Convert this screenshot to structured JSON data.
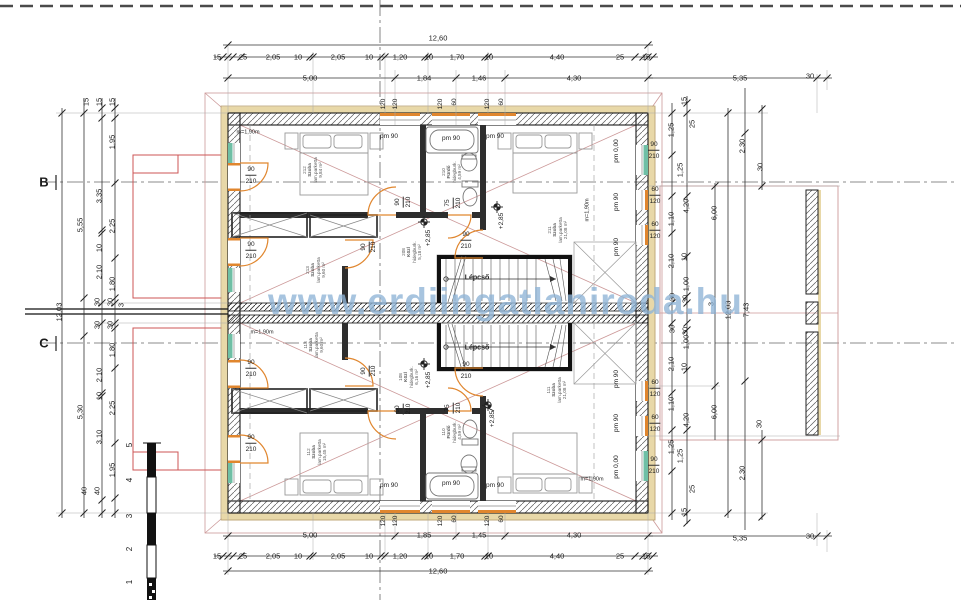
{
  "watermark": "www.erdiingatlaniroda.hu",
  "colors": {
    "door_window_accent": "#e0862e",
    "teal_window": "#6fbfa5",
    "red_outline": "#cc5555",
    "pink_roof": "#cc9999",
    "insulation_tan": "#e8d8a8",
    "watermark_blue": "#8eb4d6",
    "wall_dark": "#2e2e2e"
  },
  "rooms": [
    {
      "id": "212",
      "name": "Szoba",
      "floor": "lam.parketta",
      "area": "9,84 m²",
      "x": 313,
      "y": 170
    },
    {
      "id": "213",
      "name": "Szoba",
      "floor": "lam.parketta",
      "area": "9,60 m²",
      "x": 316,
      "y": 270
    },
    {
      "id": "208",
      "name": "Közl",
      "floor": "hidegburk.",
      "area": "5,18 m²",
      "x": 412,
      "y": 252
    },
    {
      "id": "210",
      "name": "Fürdő",
      "floor": "hidegburk.",
      "area": "4,59 m²",
      "x": 452,
      "y": 172
    },
    {
      "id": "211",
      "name": "Szoba",
      "floor": "lam.parketta",
      "area": "21,08 m²",
      "x": 558,
      "y": 230
    },
    {
      "id": "113",
      "name": "Szoba",
      "floor": "lam.parketta",
      "area": "9,60 m²",
      "x": 314,
      "y": 345
    },
    {
      "id": "112",
      "name": "Szoba",
      "floor": "lam.parketta",
      "area": "15,45 m²",
      "x": 317,
      "y": 452
    },
    {
      "id": "108",
      "name": "Közl",
      "floor": "hidegburk.",
      "area": "6,16 m²",
      "x": 409,
      "y": 377
    },
    {
      "id": "110",
      "name": "Fürdő",
      "floor": "hidegburk.",
      "area": "4,59 m²",
      "x": 452,
      "y": 432
    },
    {
      "id": "111",
      "name": "Szoba",
      "floor": "lam.parketta",
      "area": "21,08 m²",
      "x": 557,
      "y": 390
    }
  ],
  "labels": [
    {
      "t": "12,60",
      "x": 438,
      "y": 38,
      "n": "dim-overall-top"
    },
    {
      "t": "15",
      "x": 217,
      "y": 57
    },
    {
      "t": "25",
      "x": 243,
      "y": 57
    },
    {
      "t": "2,05",
      "x": 273,
      "y": 57
    },
    {
      "t": "10",
      "x": 298,
      "y": 57
    },
    {
      "t": "2,05",
      "x": 338,
      "y": 57
    },
    {
      "t": "10",
      "x": 369,
      "y": 57
    },
    {
      "t": "1,20",
      "x": 400,
      "y": 57
    },
    {
      "t": "10",
      "x": 429,
      "y": 57
    },
    {
      "t": "1,70",
      "x": 457,
      "y": 57
    },
    {
      "t": "10",
      "x": 489,
      "y": 57
    },
    {
      "t": "4,40",
      "x": 557,
      "y": 57
    },
    {
      "t": "25",
      "x": 620,
      "y": 57
    },
    {
      "t": "15",
      "x": 646,
      "y": 57
    },
    {
      "t": "5,00",
      "x": 310,
      "y": 78
    },
    {
      "t": "1,84",
      "x": 424,
      "y": 78
    },
    {
      "t": "1,46",
      "x": 479,
      "y": 78
    },
    {
      "t": "4,30",
      "x": 574,
      "y": 78
    },
    {
      "t": "5,35",
      "x": 740,
      "y": 78
    },
    {
      "t": "30",
      "x": 810,
      "y": 76
    },
    {
      "t": "120",
      "x": 384,
      "y": 104,
      "r": 1,
      "s": 6.5
    },
    {
      "t": "120",
      "x": 396,
      "y": 104,
      "r": 1,
      "s": 6.5
    },
    {
      "t": "120",
      "x": 441,
      "y": 104,
      "r": 1,
      "s": 6.5
    },
    {
      "t": "60",
      "x": 455,
      "y": 102,
      "r": 1,
      "s": 6.5
    },
    {
      "t": "120",
      "x": 488,
      "y": 104,
      "r": 1,
      "s": 6.5
    },
    {
      "t": "60",
      "x": 502,
      "y": 102,
      "r": 1,
      "s": 6.5
    },
    {
      "t": "120",
      "x": 384,
      "y": 521,
      "r": 1,
      "s": 6.5
    },
    {
      "t": "120",
      "x": 396,
      "y": 521,
      "r": 1,
      "s": 6.5
    },
    {
      "t": "120",
      "x": 441,
      "y": 521,
      "r": 1,
      "s": 6.5
    },
    {
      "t": "60",
      "x": 455,
      "y": 519,
      "r": 1,
      "s": 6.5
    },
    {
      "t": "120",
      "x": 488,
      "y": 521,
      "r": 1,
      "s": 6.5
    },
    {
      "t": "60",
      "x": 502,
      "y": 519,
      "r": 1,
      "s": 6.5
    },
    {
      "t": "5,00",
      "x": 310,
      "y": 535
    },
    {
      "t": "1,85",
      "x": 424,
      "y": 535
    },
    {
      "t": "1,45",
      "x": 479,
      "y": 535
    },
    {
      "t": "4,30",
      "x": 574,
      "y": 535
    },
    {
      "t": "5,35",
      "x": 740,
      "y": 538
    },
    {
      "t": "30",
      "x": 810,
      "y": 536
    },
    {
      "t": "15",
      "x": 217,
      "y": 556
    },
    {
      "t": "25",
      "x": 243,
      "y": 556
    },
    {
      "t": "2,05",
      "x": 273,
      "y": 556
    },
    {
      "t": "10",
      "x": 298,
      "y": 556
    },
    {
      "t": "2,05",
      "x": 338,
      "y": 556
    },
    {
      "t": "10",
      "x": 369,
      "y": 556
    },
    {
      "t": "1,20",
      "x": 400,
      "y": 556
    },
    {
      "t": "10",
      "x": 429,
      "y": 556
    },
    {
      "t": "1,70",
      "x": 457,
      "y": 556
    },
    {
      "t": "10",
      "x": 489,
      "y": 556
    },
    {
      "t": "4,40",
      "x": 557,
      "y": 556
    },
    {
      "t": "25",
      "x": 620,
      "y": 556
    },
    {
      "t": "15",
      "x": 646,
      "y": 556
    },
    {
      "t": "12,60",
      "x": 438,
      "y": 571,
      "n": "dim-overall-bottom"
    },
    {
      "t": "12,03",
      "x": 59,
      "y": 312,
      "r": 1
    },
    {
      "t": "5,55",
      "x": 80,
      "y": 225,
      "r": 1
    },
    {
      "t": "5,30",
      "x": 80,
      "y": 412,
      "r": 1
    },
    {
      "t": "15",
      "x": 86,
      "y": 102,
      "r": 1
    },
    {
      "t": "15",
      "x": 99,
      "y": 102,
      "r": 1
    },
    {
      "t": "15",
      "x": 112,
      "y": 102,
      "r": 1
    },
    {
      "t": "1,95",
      "x": 112,
      "y": 142,
      "r": 1
    },
    {
      "t": "3,35",
      "x": 99,
      "y": 196,
      "r": 1
    },
    {
      "t": "2,25",
      "x": 112,
      "y": 226,
      "r": 1
    },
    {
      "t": "10",
      "x": 99,
      "y": 248,
      "r": 1
    },
    {
      "t": "2,10",
      "x": 99,
      "y": 272,
      "r": 1
    },
    {
      "t": "1,80",
      "x": 112,
      "y": 284,
      "r": 1
    },
    {
      "t": "30",
      "x": 97,
      "y": 302,
      "r": 1
    },
    {
      "t": "30",
      "x": 110,
      "y": 302,
      "r": 1
    },
    {
      "t": "3",
      "x": 121,
      "y": 305,
      "r": 1
    },
    {
      "t": "30",
      "x": 97,
      "y": 325,
      "r": 1
    },
    {
      "t": "30",
      "x": 110,
      "y": 325,
      "r": 1
    },
    {
      "t": "1,80",
      "x": 112,
      "y": 350,
      "r": 1
    },
    {
      "t": "2,10",
      "x": 99,
      "y": 375,
      "r": 1
    },
    {
      "t": "10",
      "x": 99,
      "y": 396,
      "r": 1
    },
    {
      "t": "2,25",
      "x": 112,
      "y": 408,
      "r": 1
    },
    {
      "t": "3,10",
      "x": 99,
      "y": 437,
      "r": 1
    },
    {
      "t": "1,95",
      "x": 112,
      "y": 470,
      "r": 1
    },
    {
      "t": "40",
      "x": 84,
      "y": 491,
      "r": 1
    },
    {
      "t": "40",
      "x": 97,
      "y": 491,
      "r": 1
    },
    {
      "t": "B",
      "x": 44,
      "y": 182,
      "s": 13,
      "b": 1,
      "n": "axis-label-b"
    },
    {
      "t": "C",
      "x": 44,
      "y": 343,
      "s": 13,
      "b": 1,
      "n": "axis-label-c"
    },
    {
      "t": "15",
      "x": 684,
      "y": 101,
      "r": 1
    },
    {
      "t": "25",
      "x": 692,
      "y": 124,
      "r": 1
    },
    {
      "t": "1,25",
      "x": 671,
      "y": 130,
      "r": 1
    },
    {
      "t": "1,25",
      "x": 680,
      "y": 170,
      "r": 1
    },
    {
      "t": "2,30",
      "x": 742,
      "y": 146,
      "r": 1
    },
    {
      "t": "30",
      "x": 760,
      "y": 167,
      "r": 1
    },
    {
      "t": "4,20",
      "x": 686,
      "y": 206,
      "r": 1
    },
    {
      "t": "6,00",
      "x": 714,
      "y": 213,
      "r": 1
    },
    {
      "t": "1,10",
      "x": 671,
      "y": 219,
      "r": 1
    },
    {
      "t": "10",
      "x": 684,
      "y": 257,
      "r": 1
    },
    {
      "t": "2,10",
      "x": 671,
      "y": 261,
      "r": 1
    },
    {
      "t": "1,00",
      "x": 686,
      "y": 284,
      "r": 1
    },
    {
      "t": "30",
      "x": 672,
      "y": 297,
      "r": 1
    },
    {
      "t": "30",
      "x": 685,
      "y": 299,
      "r": 1
    },
    {
      "t": "3",
      "x": 711,
      "y": 304,
      "r": 1
    },
    {
      "t": "12,03",
      "x": 728,
      "y": 310,
      "r": 1
    },
    {
      "t": "7,43",
      "x": 746,
      "y": 310,
      "r": 1
    },
    {
      "t": "30",
      "x": 672,
      "y": 329,
      "r": 1
    },
    {
      "t": "30",
      "x": 685,
      "y": 331,
      "r": 1
    },
    {
      "t": "1,00",
      "x": 686,
      "y": 342,
      "r": 1
    },
    {
      "t": "2,10",
      "x": 671,
      "y": 364,
      "r": 1
    },
    {
      "t": "10",
      "x": 684,
      "y": 367,
      "r": 1
    },
    {
      "t": "1,10",
      "x": 671,
      "y": 404,
      "r": 1
    },
    {
      "t": "6,00",
      "x": 714,
      "y": 412,
      "r": 1
    },
    {
      "t": "4,20",
      "x": 686,
      "y": 420,
      "r": 1
    },
    {
      "t": "30",
      "x": 759,
      "y": 424,
      "r": 1
    },
    {
      "t": "1,25",
      "x": 671,
      "y": 447,
      "r": 1
    },
    {
      "t": "2,30",
      "x": 742,
      "y": 473,
      "r": 1
    },
    {
      "t": "1,25",
      "x": 680,
      "y": 456,
      "r": 1
    },
    {
      "t": "25",
      "x": 692,
      "y": 489,
      "r": 1
    },
    {
      "t": "15",
      "x": 684,
      "y": 512,
      "r": 1
    },
    {
      "t": "90",
      "x": 654,
      "y": 146,
      "s": 6.5,
      "u": 1,
      "n": "window-size"
    },
    {
      "t": "210",
      "x": 654,
      "y": 157,
      "s": 6.5,
      "n": "window-size"
    },
    {
      "t": "60",
      "x": 655,
      "y": 191,
      "s": 6.5,
      "u": 1,
      "n": "window-size"
    },
    {
      "t": "120",
      "x": 655,
      "y": 202,
      "s": 6.5,
      "n": "window-size"
    },
    {
      "t": "60",
      "x": 655,
      "y": 226,
      "s": 6.5,
      "u": 1,
      "n": "window-size"
    },
    {
      "t": "120",
      "x": 655,
      "y": 237,
      "s": 6.5,
      "n": "window-size"
    },
    {
      "t": "60",
      "x": 655,
      "y": 384,
      "s": 6.5,
      "u": 1,
      "n": "window-size"
    },
    {
      "t": "120",
      "x": 655,
      "y": 395,
      "s": 6.5,
      "n": "window-size"
    },
    {
      "t": "60",
      "x": 655,
      "y": 419,
      "s": 6.5,
      "u": 1,
      "n": "window-size"
    },
    {
      "t": "120",
      "x": 655,
      "y": 430,
      "s": 6.5,
      "n": "window-size"
    },
    {
      "t": "90",
      "x": 654,
      "y": 461,
      "s": 6.5,
      "u": 1,
      "n": "window-size"
    },
    {
      "t": "210",
      "x": 654,
      "y": 472,
      "s": 6.5,
      "n": "window-size"
    },
    {
      "t": "90",
      "x": 251,
      "y": 171,
      "s": 6.5,
      "u": 1,
      "n": "door-size"
    },
    {
      "t": "210",
      "x": 251,
      "y": 182,
      "s": 6.5,
      "n": "door-size"
    },
    {
      "t": "90",
      "x": 251,
      "y": 246,
      "s": 6.5,
      "u": 1,
      "n": "door-size"
    },
    {
      "t": "210",
      "x": 251,
      "y": 257,
      "s": 6.5,
      "n": "door-size"
    },
    {
      "t": "90",
      "x": 251,
      "y": 364,
      "s": 6.5,
      "u": 1,
      "n": "door-size"
    },
    {
      "t": "210",
      "x": 251,
      "y": 375,
      "s": 6.5,
      "n": "door-size"
    },
    {
      "t": "90",
      "x": 251,
      "y": 439,
      "s": 6.5,
      "u": 1,
      "n": "door-size"
    },
    {
      "t": "210",
      "x": 251,
      "y": 450,
      "s": 6.5,
      "n": "door-size"
    },
    {
      "t": "90",
      "x": 399,
      "y": 202,
      "r": 1,
      "s": 6.5,
      "u": 1,
      "n": "door-size"
    },
    {
      "t": "210",
      "x": 409,
      "y": 202,
      "r": 1,
      "s": 6.5,
      "n": "door-size"
    },
    {
      "t": "75",
      "x": 449,
      "y": 203,
      "r": 1,
      "s": 6.5,
      "u": 1,
      "n": "door-size"
    },
    {
      "t": "210",
      "x": 459,
      "y": 203,
      "r": 1,
      "s": 6.5,
      "n": "door-size"
    },
    {
      "t": "90",
      "x": 365,
      "y": 247,
      "r": 1,
      "s": 6.5,
      "u": 1,
      "n": "door-size"
    },
    {
      "t": "210",
      "x": 374,
      "y": 247,
      "r": 1,
      "s": 6.5,
      "n": "door-size"
    },
    {
      "t": "90",
      "x": 466,
      "y": 236,
      "s": 6.5,
      "u": 1,
      "n": "door-size"
    },
    {
      "t": "210",
      "x": 466,
      "y": 247,
      "s": 6.5,
      "n": "door-size"
    },
    {
      "t": "90",
      "x": 399,
      "y": 409,
      "r": 1,
      "s": 6.5,
      "u": 1,
      "n": "door-size"
    },
    {
      "t": "210",
      "x": 409,
      "y": 409,
      "r": 1,
      "s": 6.5,
      "n": "door-size"
    },
    {
      "t": "75",
      "x": 449,
      "y": 408,
      "r": 1,
      "s": 6.5,
      "u": 1,
      "n": "door-size"
    },
    {
      "t": "210",
      "x": 459,
      "y": 408,
      "r": 1,
      "s": 6.5,
      "n": "door-size"
    },
    {
      "t": "90",
      "x": 365,
      "y": 371,
      "r": 1,
      "s": 6.5,
      "u": 1,
      "n": "door-size"
    },
    {
      "t": "210",
      "x": 374,
      "y": 371,
      "r": 1,
      "s": 6.5,
      "n": "door-size"
    },
    {
      "t": "90",
      "x": 466,
      "y": 366,
      "s": 6.5,
      "u": 1,
      "n": "door-size"
    },
    {
      "t": "210",
      "x": 466,
      "y": 377,
      "s": 6.5,
      "n": "door-size"
    },
    {
      "t": "pm 90",
      "x": 389,
      "y": 137,
      "s": 6.5,
      "n": "sill-height"
    },
    {
      "t": "pm 90",
      "x": 451,
      "y": 139,
      "s": 6.5,
      "n": "sill-height"
    },
    {
      "t": "pm 90",
      "x": 495,
      "y": 137,
      "s": 6.5,
      "n": "sill-height"
    },
    {
      "t": "pm 90",
      "x": 389,
      "y": 486,
      "s": 6.5,
      "n": "sill-height"
    },
    {
      "t": "pm 90",
      "x": 451,
      "y": 484,
      "s": 6.5,
      "n": "sill-height"
    },
    {
      "t": "pm 90",
      "x": 495,
      "y": 486,
      "s": 6.5,
      "n": "sill-height"
    },
    {
      "t": "pm 0,00",
      "x": 617,
      "y": 151,
      "r": 1,
      "s": 6.5,
      "n": "sill-height"
    },
    {
      "t": "pm 90",
      "x": 617,
      "y": 202,
      "r": 1,
      "s": 6.5,
      "n": "sill-height"
    },
    {
      "t": "pm 90",
      "x": 617,
      "y": 247,
      "r": 1,
      "s": 6.5,
      "n": "sill-height"
    },
    {
      "t": "pm 90",
      "x": 617,
      "y": 379,
      "r": 1,
      "s": 6.5,
      "n": "sill-height"
    },
    {
      "t": "pm 90",
      "x": 617,
      "y": 423,
      "r": 1,
      "s": 6.5,
      "n": "sill-height"
    },
    {
      "t": "pm 0,00",
      "x": 617,
      "y": 467,
      "r": 1,
      "s": 6.5,
      "n": "sill-height"
    },
    {
      "t": "m=1,90m",
      "x": 248,
      "y": 133,
      "s": 5.5,
      "n": "kneewall-height"
    },
    {
      "t": "m=1,90m",
      "x": 588,
      "y": 210,
      "r": 1,
      "s": 5.5,
      "n": "kneewall-height"
    },
    {
      "t": "m=1,90m",
      "x": 592,
      "y": 480,
      "s": 5.5,
      "n": "kneewall-height"
    },
    {
      "t": "m=1,90m",
      "x": 262,
      "y": 333,
      "s": 5.5,
      "n": "kneewall-height"
    },
    {
      "t": "+2,85",
      "x": 429,
      "y": 238,
      "r": 1,
      "s": 6.5,
      "n": "level-mark"
    },
    {
      "t": "+2,85",
      "x": 502,
      "y": 221,
      "r": 1,
      "s": 6.5,
      "n": "level-mark"
    },
    {
      "t": "+2,85",
      "x": 429,
      "y": 380,
      "r": 1,
      "s": 6.5,
      "n": "level-mark"
    },
    {
      "t": "+2,85",
      "x": 493,
      "y": 419,
      "r": 1,
      "s": 6.5,
      "n": "level-mark"
    },
    {
      "t": "Lépcső",
      "x": 477,
      "y": 278,
      "s": 7,
      "b": 1,
      "n": "stair-label"
    },
    {
      "t": "Lépcső",
      "x": 477,
      "y": 348,
      "s": 7,
      "b": 1,
      "n": "stair-label"
    },
    {
      "t": "5",
      "x": 130,
      "y": 445,
      "r": 1,
      "s": 8,
      "n": "scale-number"
    },
    {
      "t": "4",
      "x": 130,
      "y": 480,
      "r": 1,
      "s": 8,
      "n": "scale-number"
    },
    {
      "t": "3",
      "x": 130,
      "y": 516,
      "r": 1,
      "s": 8,
      "n": "scale-number"
    },
    {
      "t": "2",
      "x": 130,
      "y": 549,
      "r": 1,
      "s": 8,
      "n": "scale-number"
    },
    {
      "t": "1",
      "x": 130,
      "y": 582,
      "r": 1,
      "s": 8,
      "n": "scale-number"
    }
  ],
  "chains": [
    {
      "o": "h",
      "p": 45,
      "ticks": [
        228,
        648
      ]
    },
    {
      "o": "h",
      "p": 57,
      "ticks": [
        223,
        228,
        233,
        241,
        310,
        313,
        381,
        385,
        425,
        428,
        485,
        488,
        635,
        643,
        648,
        653
      ]
    },
    {
      "o": "h",
      "p": 78,
      "ticks": [
        228,
        395,
        456,
        505,
        648,
        817,
        827
      ]
    },
    {
      "o": "h",
      "p": 536,
      "ticks": [
        228,
        395,
        456,
        505,
        648,
        817,
        827
      ]
    },
    {
      "o": "h",
      "p": 556,
      "ticks": [
        223,
        228,
        233,
        241,
        310,
        313,
        381,
        385,
        425,
        428,
        485,
        488,
        635,
        643,
        648,
        653
      ]
    },
    {
      "o": "h",
      "p": 571,
      "ticks": [
        228,
        648
      ]
    },
    {
      "o": "v",
      "p": 62,
      "ticks": [
        113,
        513
      ]
    },
    {
      "o": "v",
      "p": 84,
      "ticks": [
        113,
        298,
        336,
        513
      ]
    },
    {
      "o": "v",
      "p": 102,
      "ticks": [
        108,
        118,
        230,
        233,
        303,
        323,
        393,
        396,
        500,
        513
      ]
    },
    {
      "o": "v",
      "p": 115,
      "ticks": [
        108,
        118,
        183,
        258,
        298,
        303,
        323,
        328,
        368,
        443,
        498,
        513
      ]
    },
    {
      "o": "v",
      "p": 672,
      "ticks": [
        113,
        155,
        196,
        233,
        303,
        323,
        393,
        430,
        471,
        513
      ]
    },
    {
      "o": "v",
      "p": 687,
      "ticks": [
        103,
        113,
        196,
        256,
        296,
        303,
        323,
        330,
        370,
        430,
        513,
        523
      ]
    },
    {
      "o": "v",
      "p": 715,
      "ticks": [
        186,
        386
      ]
    },
    {
      "o": "v",
      "p": 728,
      "ticks": [
        113,
        513
      ]
    },
    {
      "o": "v",
      "p": 745,
      "ticks": [
        133,
        381
      ]
    },
    {
      "o": "v",
      "p": 762,
      "ticks": [
        109,
        186,
        440,
        517
      ]
    }
  ]
}
